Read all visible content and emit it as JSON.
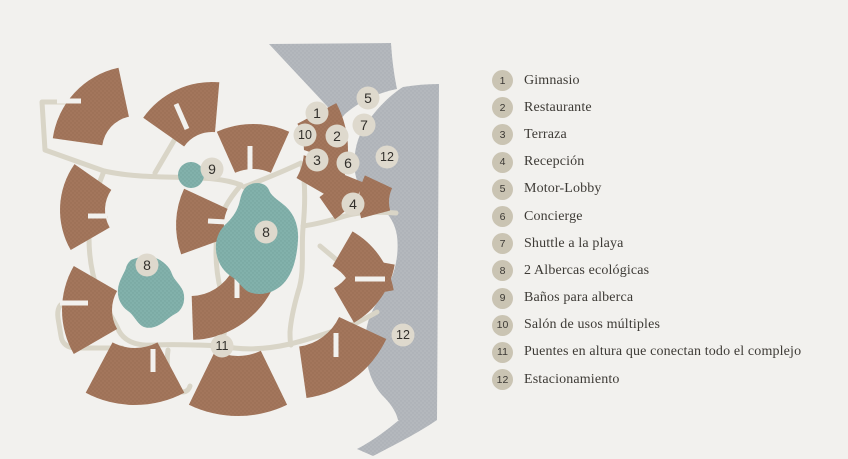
{
  "map": {
    "name": "resort-site-plan",
    "colors": {
      "background": "#f2f1ee",
      "building": "#a3765c",
      "building_dot": "#986c51",
      "pool": "#82b1ab",
      "pool_dot": "#75a39d",
      "road": "#b4b8bd",
      "road_dot": "#a8adb3",
      "path": "#d9d5c7",
      "marker_fill": "#ded9cd",
      "marker_text": "#32302c",
      "legend_circle": "#cac4b3",
      "legend_text": "#3d3a35"
    },
    "markers": [
      {
        "n": "1",
        "x": 317,
        "y": 113
      },
      {
        "n": "10",
        "x": 305,
        "y": 135
      },
      {
        "n": "2",
        "x": 337,
        "y": 136
      },
      {
        "n": "3",
        "x": 317,
        "y": 160
      },
      {
        "n": "6",
        "x": 348,
        "y": 163
      },
      {
        "n": "5",
        "x": 368,
        "y": 98
      },
      {
        "n": "7",
        "x": 364,
        "y": 125
      },
      {
        "n": "12",
        "x": 387,
        "y": 157
      },
      {
        "n": "4",
        "x": 353,
        "y": 204
      },
      {
        "n": "9",
        "x": 212,
        "y": 169
      },
      {
        "n": "8",
        "x": 266,
        "y": 232
      },
      {
        "n": "8",
        "x": 147,
        "y": 265
      },
      {
        "n": "11",
        "x": 222,
        "y": 346
      },
      {
        "n": "12",
        "x": 403,
        "y": 335
      }
    ]
  },
  "legend": {
    "items": [
      {
        "n": "1",
        "label": "Gimnasio"
      },
      {
        "n": "2",
        "label": "Restaurante"
      },
      {
        "n": "3",
        "label": "Terraza"
      },
      {
        "n": "4",
        "label": "Recepción"
      },
      {
        "n": "5",
        "label": "Motor-Lobby"
      },
      {
        "n": "6",
        "label": "Concierge"
      },
      {
        "n": "7",
        "label": "Shuttle a la playa"
      },
      {
        "n": "8",
        "label": "2 Albercas ecológicas"
      },
      {
        "n": "9",
        "label": "Baños para alberca"
      },
      {
        "n": "10",
        "label": "Salón de usos múltiples"
      },
      {
        "n": "11",
        "label": "Puentes en altura que conectan todo el complejo"
      },
      {
        "n": "12",
        "label": "Estacionamiento"
      }
    ]
  }
}
